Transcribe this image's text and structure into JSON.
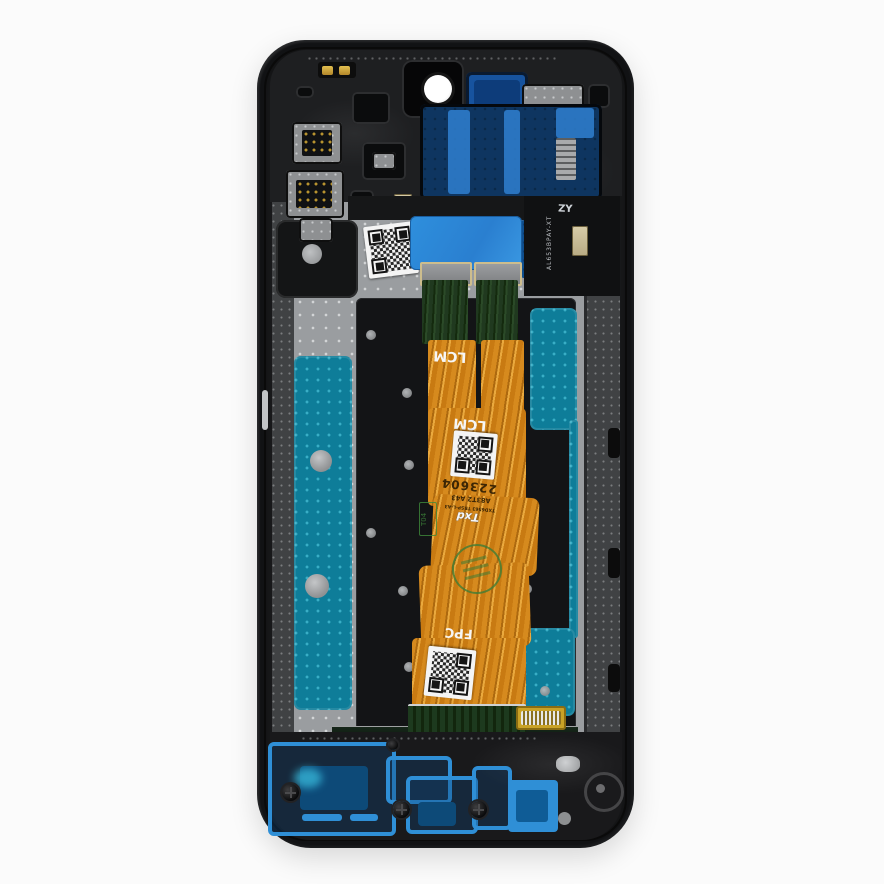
{
  "scene": {
    "type": "product-photo",
    "subject": "Smartphone LCD screen assembly with frame, rear view",
    "background_color": "#fbfbfb"
  },
  "colors": {
    "frame_black": "#141414",
    "plate_silver": "#9a9da0",
    "lcd_plate_black": "#131416",
    "adhesive_teal": "#0e7d99",
    "adhesive_blue_bottom": "#2f8fd6",
    "sticker_blue": "#2e8fdd",
    "adhesive_navy": "#0e3560",
    "flex_orange": "#cf7f17",
    "pcb_green": "#1d3a1e",
    "connector_gold": "#c9a227",
    "label_white": "#f4f4f4",
    "stamp_green": "#3f7d36"
  },
  "markings": {
    "lcm_print": "LCM",
    "lcm_print_2": "LCM",
    "fpc_print": "FPC",
    "serial": "223604",
    "model_code": "A83T2 A43",
    "part_line": "TXD6563 TRSP-L-A3",
    "brand_logo": "Txd",
    "stamp_box": "T04",
    "frame_label": "ZY",
    "frame_code": "AL653BPAY-XT"
  }
}
